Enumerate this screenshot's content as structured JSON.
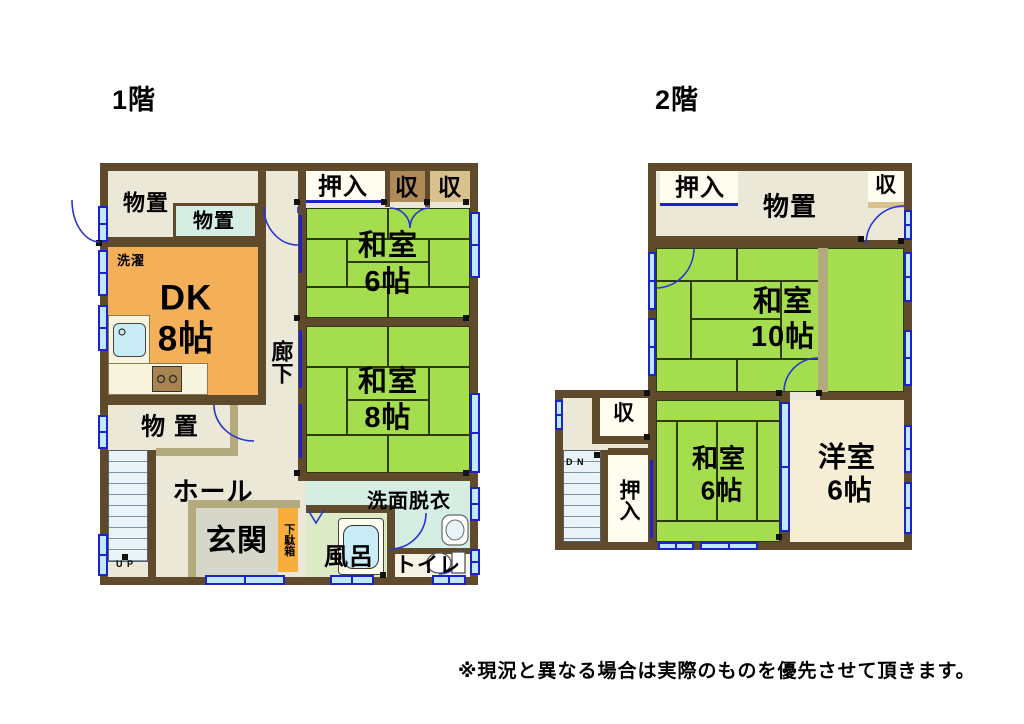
{
  "titles": {
    "floor1": "1階",
    "floor2": "2階"
  },
  "note": "※現況と異なる場合は実際のものを優先させて頂きます。",
  "colors": {
    "wall": "#5f4a2b",
    "cream": "#ebe8d8",
    "khaki": "#b3aa7d",
    "dk_orange": "#f4b058",
    "geta_orange": "#f8ae3c",
    "tatami_green": "#a4dd4d",
    "tatami_line": "#2f3a08",
    "closet_brown": "#ae8a58",
    "closet_tan": "#d9c18d",
    "closet_white": "#fffdf0",
    "washroom_cyan": "#d5eee3",
    "bath_floor": "#dcebc6",
    "tub_cyan": "#c9ecf6",
    "toilet_floor": "#f7f4e6",
    "genkan_gray": "#d6d6c9",
    "stair_blue": "#eaf3f7",
    "window_cyan": "#bfe8f8",
    "window_blue": "#1c23cb",
    "counter": "#f7f3dd",
    "western_cream": "#f5eed5",
    "stove_brown": "#a8854f"
  },
  "floor1": {
    "storage_tl": "物置",
    "storage_tl_small": "物置",
    "oshiire": "押入",
    "shu_a": "収",
    "shu_b": "収",
    "washitsu6_name": "和室",
    "washitsu6_size": "6帖",
    "laundry": "洗濯",
    "dk_name": "DK",
    "dk_size": "8帖",
    "rouka": "廊下",
    "washitsu8_name": "和室",
    "washitsu8_size": "8帖",
    "storage2": "物 置",
    "hall": "ホール",
    "genkan": "玄関",
    "getabako": "下駄箱",
    "senmen": "洗面脱衣",
    "furo": "風呂",
    "toilet": "トイレ",
    "up": "U P"
  },
  "floor2": {
    "oshiire_top": "押入",
    "monooki": "物置",
    "shu_top": "収",
    "washitsu10_name": "和室",
    "washitsu10_size": "10帖",
    "shu_mid": "収",
    "dn": "D N",
    "oshiire_side": "押入",
    "washitsu6_name": "和室",
    "washitsu6_size": "6帖",
    "youshitsu_name": "洋室",
    "youshitsu_size": "6帖"
  }
}
